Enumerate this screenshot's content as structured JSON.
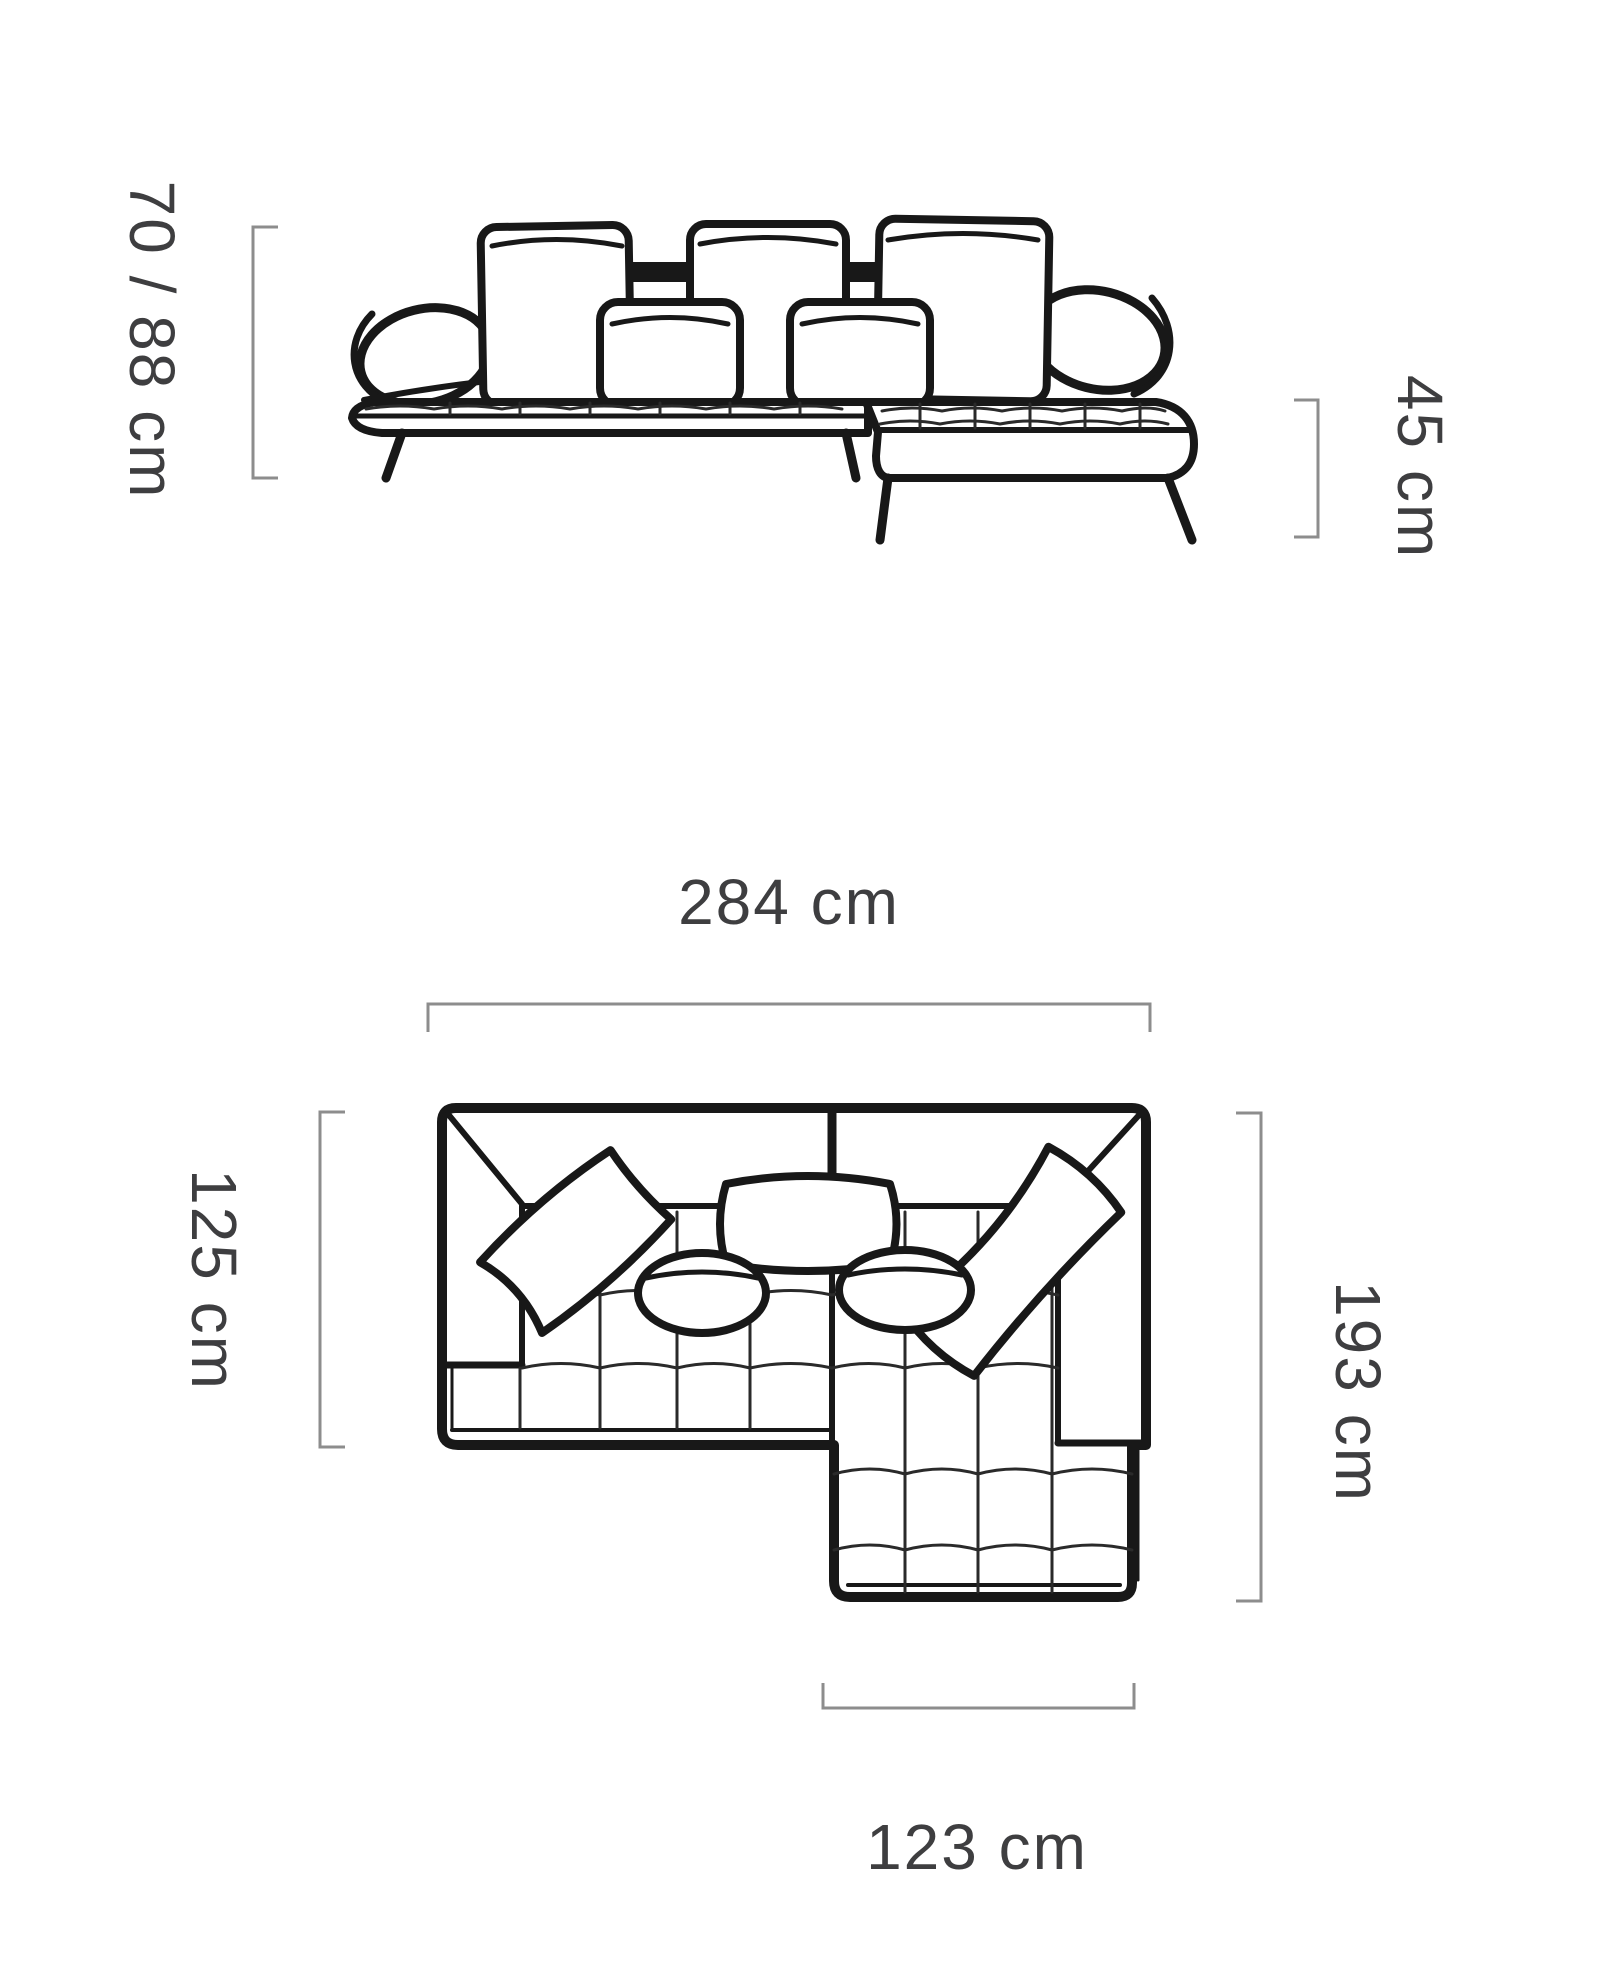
{
  "page": {
    "background": "#ffffff"
  },
  "colors": {
    "sofa_line": "#181818",
    "dimension_line": "#8d8d8d",
    "label_text": "#3e3e40"
  },
  "diagram": {
    "front_view": {
      "title": "sofa-front-view",
      "back_height_label": "70 / 88 cm",
      "seat_height_label": "45 cm"
    },
    "top_view": {
      "title": "sofa-top-view",
      "total_width_label": "284 cm",
      "sofa_depth_label": "125 cm",
      "total_depth_label": "193 cm",
      "chaise_width_label": "123 cm"
    }
  }
}
